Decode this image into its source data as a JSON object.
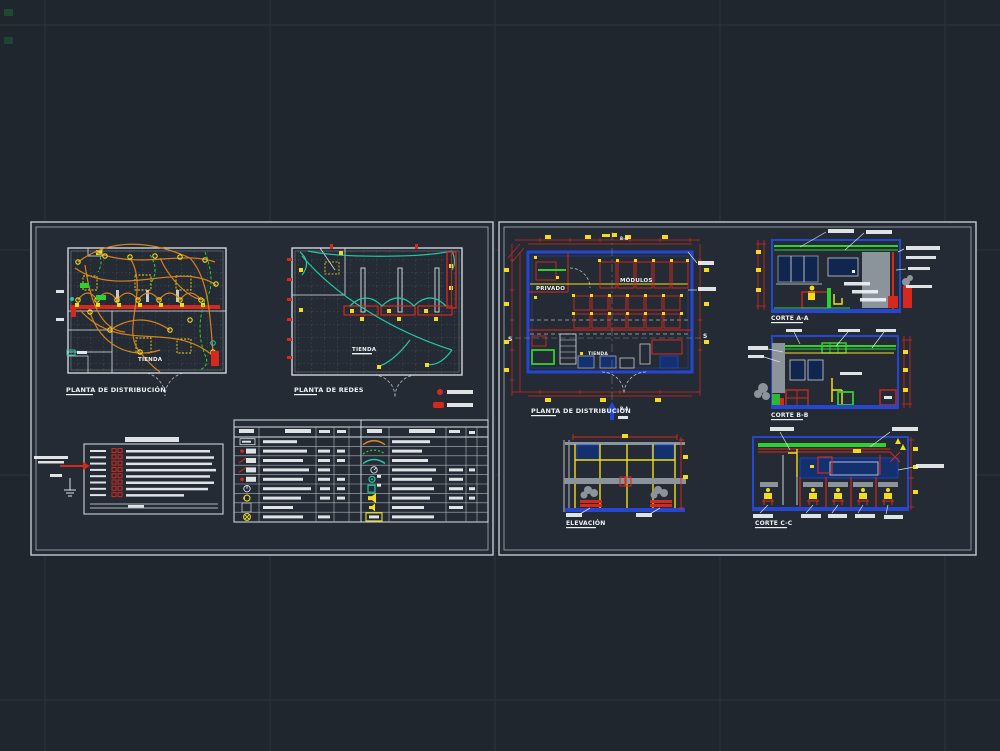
{
  "palette": {
    "background": "#20262e",
    "sheet_fill": "#242b34",
    "sheet_border": "#c3c9d1",
    "wiring_orange": "#d8821f",
    "network_teal": "#23c7a5",
    "dimension_red": "#d6281c",
    "wall_blue": "#2547cf",
    "circuit_green": "#2fd12f",
    "dim_text_yellow": "#f2dc1b",
    "detail_gray": "#8b939b"
  },
  "left_sheet": {
    "plan_distribucion": {
      "title": "PLANTA DE DISTRIBUCIÓN",
      "room_label": "TIENDA"
    },
    "plan_redes": {
      "title": "PLANTA DE REDES",
      "room_label": "TIENDA"
    }
  },
  "right_sheet": {
    "plan": {
      "title": "PLANTA DE DISTRIBUCIÓN",
      "room_privado": "PRIVADO",
      "room_modulos": "MÓDULOS",
      "room_tienda": "TIENDA",
      "marker_top": "B-A",
      "marker_bottom": "B-A",
      "section_left": "S",
      "section_right": "S"
    },
    "corte_aa": {
      "label": "CORTE A-A"
    },
    "corte_bb": {
      "label": "CORTE B-B"
    },
    "elevacion": {
      "label": "ELEVACIÓN"
    },
    "corte_cc": {
      "label": "CORTE C-C"
    }
  }
}
